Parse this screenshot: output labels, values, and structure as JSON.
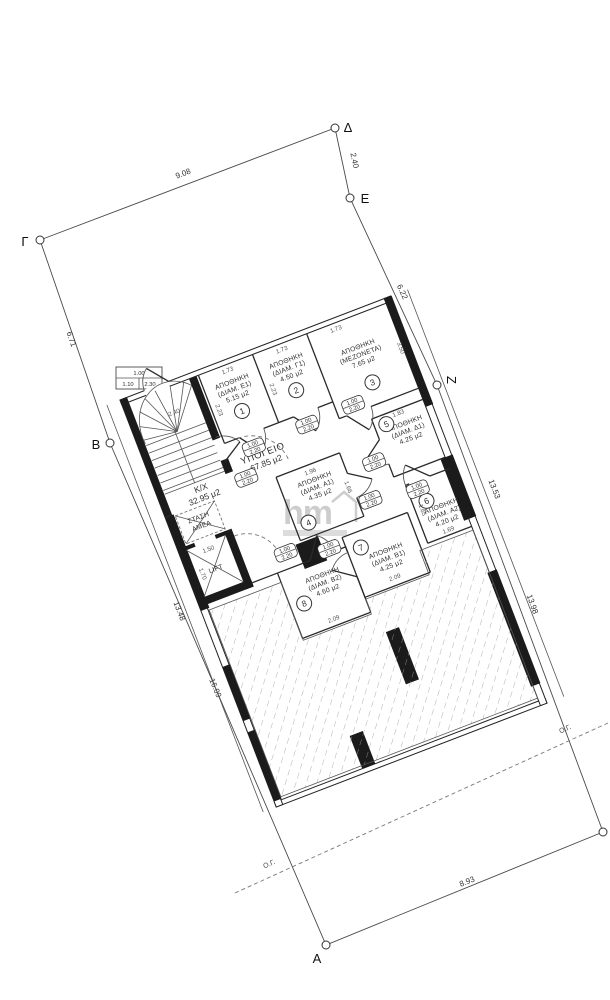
{
  "boundary": {
    "vertex_labels": [
      "Γ",
      "Δ",
      "Ε",
      "Ζ",
      "Α",
      "Β"
    ],
    "segment_dims": {
      "gd": "9.08",
      "de": "2.40",
      "ez": "6.22",
      "zr": "13.98",
      "ra": "8.93",
      "ab": "16.09",
      "bg": "6.71"
    },
    "building_line_label": "Ο.Γ."
  },
  "building": {
    "spaces": {
      "basement": {
        "name": "ΥΠΟΓΕΙΟ",
        "area": "67.85 μ2"
      },
      "common": {
        "name": "Κ/Χ",
        "area": "32.95 μ2"
      },
      "lift": {
        "name": "LIFT"
      },
      "amea": {
        "line1": "ΣΤΑΣΗ",
        "line2": "ΑΜΕΑ"
      }
    },
    "storage_rooms": [
      {
        "num": "1",
        "name": "ΑΠΟΘΗΚΗ",
        "unit": "(ΔΙΑΜ. Ε1)",
        "area": "5.15 μ2"
      },
      {
        "num": "2",
        "name": "ΑΠΟΘΗΚΗ",
        "unit": "(ΔΙΑΜ. Γ1)",
        "area": "4.50 μ2"
      },
      {
        "num": "3",
        "name": "ΑΠΟΘΗΚΗ",
        "unit": "(ΜΕΖΟΝΕΤΑ)",
        "area": "7.65 μ2"
      },
      {
        "num": "4",
        "name": "ΑΠΟΘΗΚΗ",
        "unit": "(ΔΙΑΜ. Α1)",
        "area": "4.35 μ2"
      },
      {
        "num": "5",
        "name": "ΑΠΟΘΗΚΗ",
        "unit": "(ΔΙΑΜ. Δ1)",
        "area": "4.25 μ2"
      },
      {
        "num": "6",
        "name": "ΑΠΟΘΗΚΗ",
        "unit": "(ΔΙΑΜ. Α2)",
        "area": "4.20 μ2"
      },
      {
        "num": "7",
        "name": "ΑΠΟΘΗΚΗ",
        "unit": "(ΔΙΑΜ. Β1)",
        "area": "4.25 μ2"
      },
      {
        "num": "8",
        "name": "ΑΠΟΘΗΚΗ",
        "unit": "(ΔΙΑΜ. Β2)",
        "area": "4.60 μ2"
      }
    ],
    "door_tag": {
      "top": "1.00",
      "bottom": "2.20"
    },
    "entry_tag": {
      "top": "1.00",
      "mid": "1.10",
      "bottom": "2.30"
    },
    "wall_dims": [
      "1.73",
      "1.73",
      "1.73",
      "2.23",
      "2.23",
      "3.50",
      "2.40",
      "1.96",
      "1.66",
      "1.83",
      "1.69",
      "1.65",
      "2.09",
      "2.09",
      "1.50",
      "1.70",
      "13.48",
      "13.53"
    ]
  },
  "watermark": {
    "logo": "hm"
  }
}
